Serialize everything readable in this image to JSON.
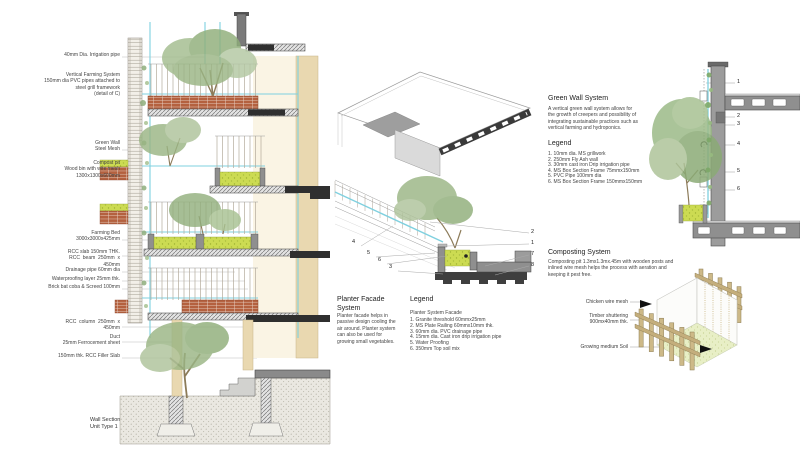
{
  "left": {
    "annotations": [
      "40mm Dia. Irrigation pipe",
      "Vertical Farming System\n150mm dia PVC pipes attached to\nsteel grill framework\n(detail of C)",
      "Green Wall\nSteel Mesh",
      "Compost pit\nWood bin with wire mesh\n1300x1300x600mm",
      "Farming Bed\n3000x3000x425mm",
      "RCC slab 150mm THK.\nRCC  beam  250mm  x\n450mm",
      "Drainage pipe 60mm dia",
      "Waterproofing layer 25mm thk.",
      "Brick bat coba & Screed 100mm",
      "RCC  column  250mm  x\n450mm",
      "Duct\n25mm Ferrocement sheet",
      "150mm thk. RCC Filler Slab"
    ],
    "title": "Wall Section\nUnit Type 1"
  },
  "planter": {
    "title": "Planter Facade\nSystem",
    "body": "Planter facade helps in\npassive design cooling the\nair around. Planter system\ncan also be used for\ngrowing small vegetables.",
    "legend_title": "Legend",
    "legend_subtitle": "Planter System Facade",
    "legend_items": [
      "1. Granite threshold 60mmx25mm",
      "2. MS Plate Railing 60mmx10mm thk.",
      "3. 60mm dia. PVC drainage pipe",
      "4. 15mm dia. Cast iron drip irrigation pipe",
      "5. Water Proofing",
      "6. 350mm Top soil mix"
    ],
    "callouts_right": [
      "2",
      "1",
      "7",
      "8"
    ],
    "callouts_left": [
      "4",
      "5",
      "6",
      "3"
    ]
  },
  "greenwall": {
    "title": "Green Wall System",
    "body": "A vertical green wall system allows for\nthe growth of creepers and possibility of\nintegrating sustainable practices such as\nvertical farming and hydroponics.",
    "legend_title": "Legend",
    "legend_items": [
      "1. 10mm dia. MS grillwork",
      "2. 250mm Fly Ash wall",
      "3. 30mm cast iron Drip irrigation pipe",
      "4. MS Box Section Frame 75mmx150mm",
      "5. PVC Pipe 100mm dia",
      "6. MS Box Section Frame 150mmx150mm"
    ],
    "callouts": [
      "1",
      "2",
      "3",
      "4",
      "5",
      "6"
    ]
  },
  "composting": {
    "title": "Composting System",
    "body": "Composting pit 1.3mx1.3mx.45m with wooden posts and\ninlined wire mesh helps the process with aeration and\nkeeping it pest free.",
    "labels": [
      "Chicken wire mesh",
      "Timber shuttering\n900mx40mm thk.",
      "Growing medium Soil"
    ]
  },
  "colors": {
    "soil_green": "#cfdf55",
    "pipe_cyan": "#7fd0df",
    "brick_red": "#b4613f",
    "timber_tan": "#cdb988",
    "concrete_gray": "#8f8f8f",
    "wall_beige": "#e9d8b0"
  }
}
